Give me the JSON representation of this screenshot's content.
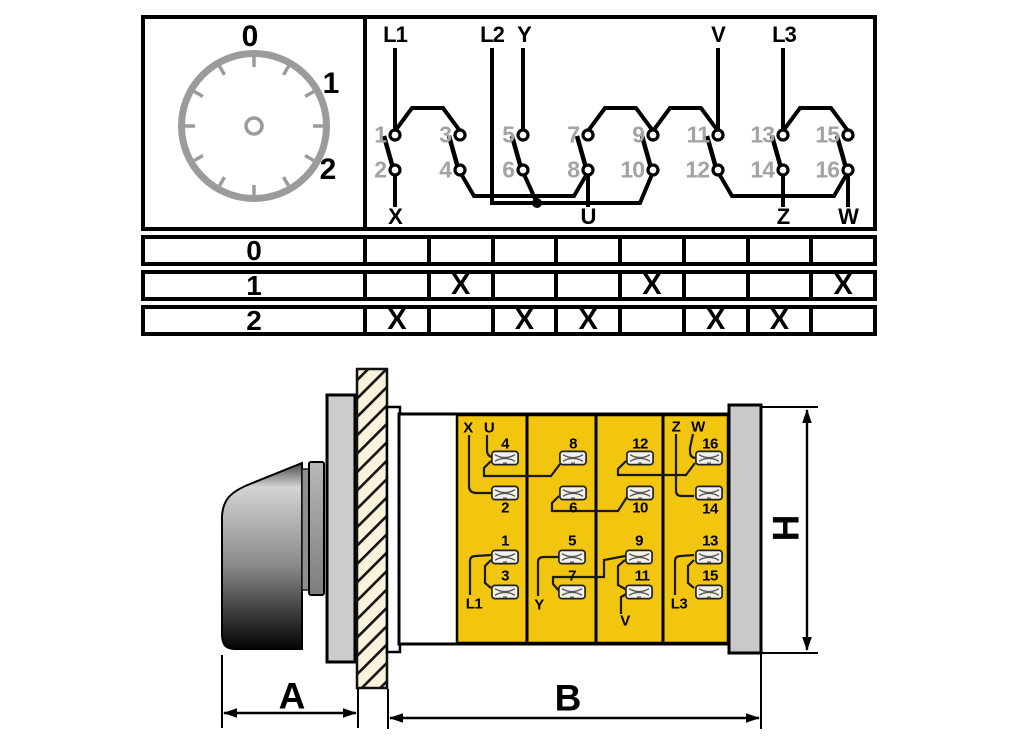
{
  "dial": {
    "position_labels": [
      "0",
      "1",
      "2"
    ]
  },
  "circuit": {
    "top_terminals": [
      "L1",
      "L2",
      "Y",
      "V",
      "L3"
    ],
    "bottom_terminals": [
      "X",
      "U",
      "Z",
      "W"
    ],
    "contact_numbers_top": [
      "1",
      "3",
      "5",
      "7",
      "9",
      "11",
      "13",
      "15"
    ],
    "contact_numbers_bottom": [
      "2",
      "4",
      "6",
      "8",
      "10",
      "12",
      "14",
      "16"
    ]
  },
  "switch_table": {
    "row_labels": [
      "0",
      "1",
      "2"
    ],
    "marks": [
      [
        "",
        "",
        "",
        "",
        "",
        "",
        "",
        ""
      ],
      [
        "",
        "X",
        "",
        "",
        "X",
        "",
        "",
        "X"
      ],
      [
        "X",
        "",
        "X",
        "X",
        "",
        "X",
        "X",
        ""
      ]
    ]
  },
  "terminal_block": {
    "corner_top": [
      "X",
      "U",
      "Z",
      "W"
    ],
    "corner_bottom": [
      "L1",
      "Y",
      "V",
      "L3"
    ],
    "upper_top_numbers": [
      "4",
      "8",
      "12",
      "16"
    ],
    "upper_bottom_numbers": [
      "2",
      "6",
      "10",
      "14"
    ],
    "lower_top_numbers": [
      "1",
      "5",
      "9",
      "13"
    ],
    "lower_bottom_numbers": [
      "3",
      "7",
      "11",
      "15"
    ]
  },
  "dimensions": {
    "front_depth": "A",
    "body_depth": "B",
    "height": "H"
  },
  "colors": {
    "terminal_yellow": "#f2c50e",
    "panel_cream": "#f8f3da",
    "plate_gray": "#cccccc",
    "contact_number_gray": "#a3a3a3"
  }
}
